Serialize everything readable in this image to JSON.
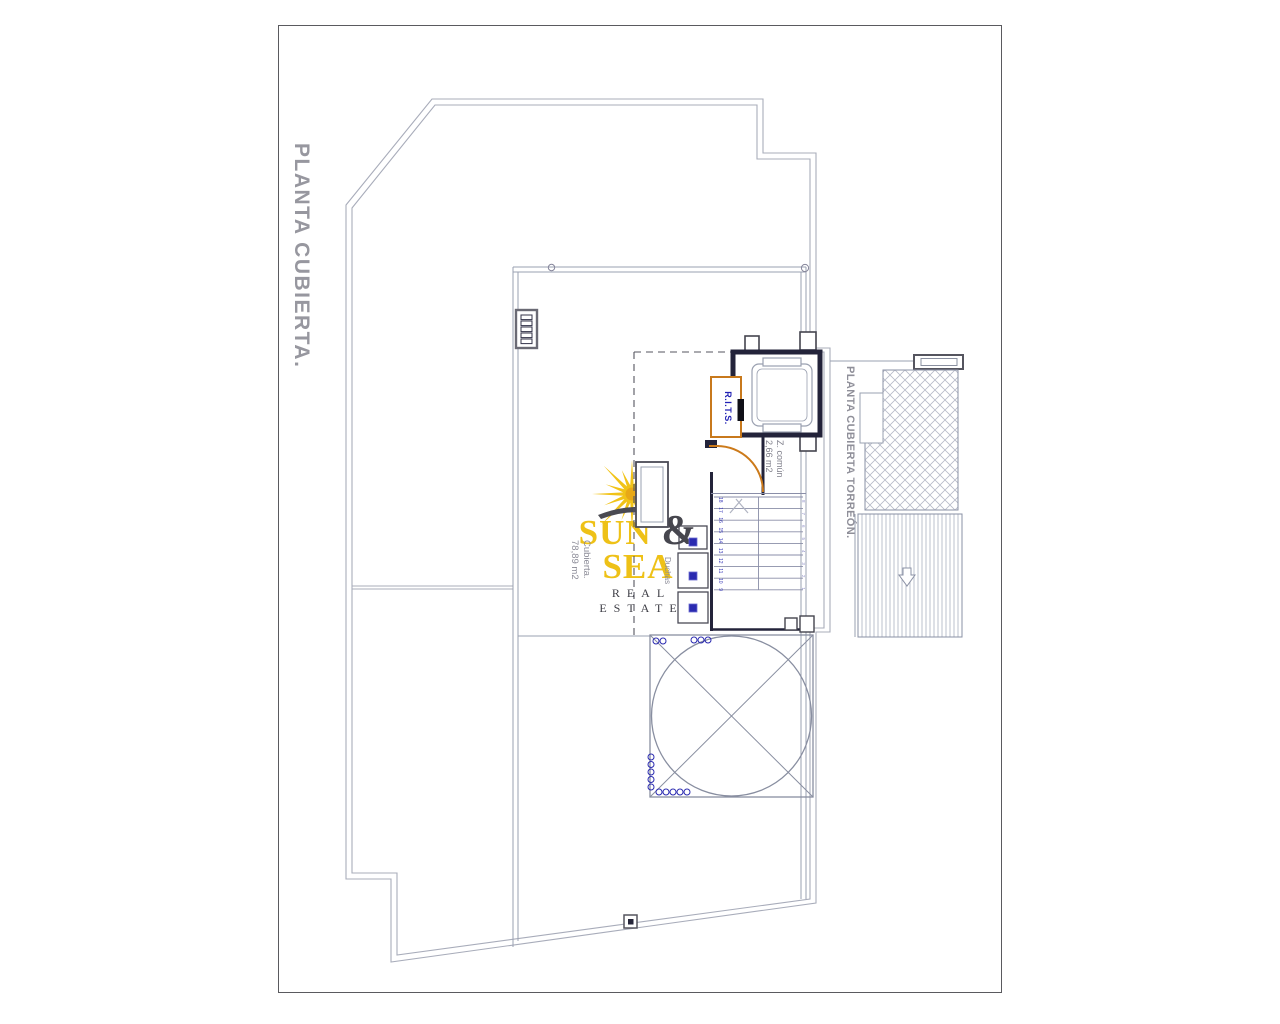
{
  "drawing": {
    "sheet_title": "PLANTA CUBIERTA.",
    "tower_title": "PLANTA CUBIERTA TORREÓN."
  },
  "rooms": {
    "rits_label": "R.I.T.S.",
    "common_zone_name": "Z. común",
    "common_zone_area": "2,66 m2",
    "roof_name": "Cubierta.",
    "roof_area": "78,89 m2",
    "showers_label": "Duchas"
  },
  "stairs": {
    "left_numbers": [
      "18",
      "17",
      "16",
      "15",
      "14",
      "13",
      "12",
      "11",
      "10",
      "9"
    ],
    "right_numbers": [
      "8",
      "7",
      "6",
      "5",
      "4",
      "3",
      "2",
      "1"
    ]
  },
  "logo": {
    "word1": "SUN",
    "amp": "&",
    "word2": "SEA",
    "tagline": "REAL ESTATE"
  },
  "colors": {
    "line_gray": "#a0a4b4",
    "dark_wall": "#23233a",
    "accent_blue": "#2222b4",
    "accent_orange": "#c8781e",
    "label_gray": "#8f8f99",
    "logo_yellow": "#eec117",
    "logo_dark": "#46464e"
  }
}
